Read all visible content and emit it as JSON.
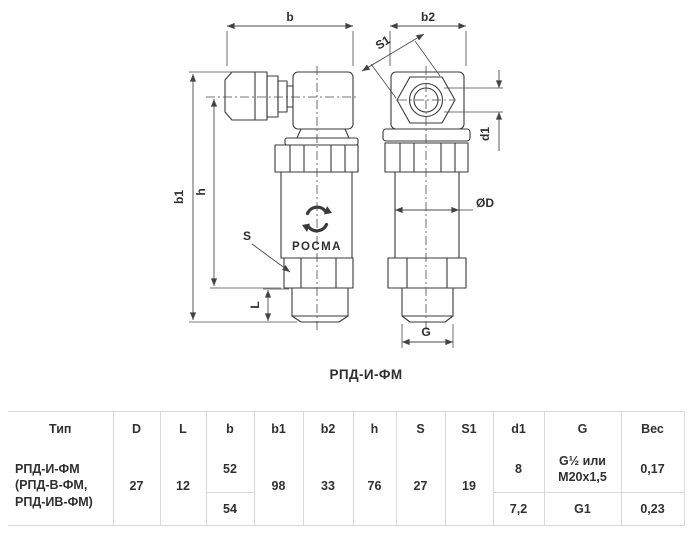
{
  "diagram": {
    "caption": "РПД-И-ФМ",
    "brand": "РОСМА",
    "dims": {
      "b": "b",
      "b1": "b1",
      "b2": "b2",
      "h": "h",
      "s": "S",
      "s1": "S1",
      "l": "L",
      "d1": "d1",
      "od": "ØD",
      "g": "G"
    }
  },
  "table": {
    "headers": {
      "type": "Тип",
      "d": "D",
      "l": "L",
      "b": "b",
      "b1": "b1",
      "b2": "b2",
      "h": "h",
      "s": "S",
      "s1": "S1",
      "d1": "d1",
      "g": "G",
      "weight": "Вес"
    },
    "row": {
      "type": "РПД-И-ФМ\n(РПД-В-ФМ,\nРПД-ИВ-ФМ)",
      "d": "27",
      "l": "12",
      "b_top": "52",
      "b_bottom": "54",
      "b1": "98",
      "b2": "33",
      "h": "76",
      "s": "27",
      "s1": "19",
      "d1_top": "8",
      "d1_bottom": "7,2",
      "g_top": "G½ или\nМ20х1,5",
      "g_bottom": "G1",
      "weight_top": "0,17",
      "weight_bottom": "0,23"
    }
  }
}
